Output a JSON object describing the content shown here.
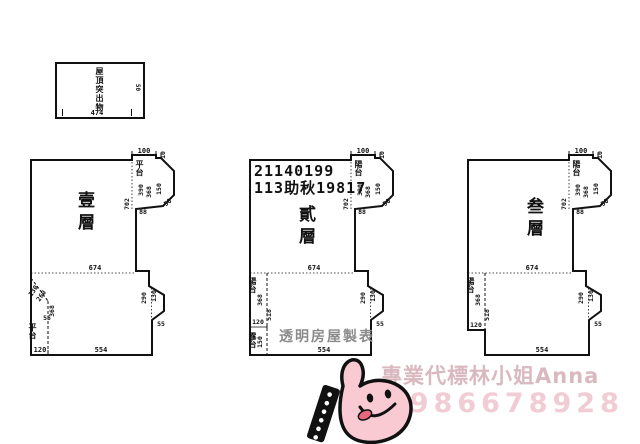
{
  "roof_box": {
    "label": "屋頂突出物",
    "width_dim": "474",
    "height_dim": "50"
  },
  "case": {
    "line1": "21140199",
    "line2": "113助秋19817"
  },
  "floors": [
    {
      "name": "壹層",
      "terrace": "平台",
      "top": "100",
      "step": "10",
      "p1": "390",
      "p2": "368",
      "p3": "150",
      "side": "702",
      "base": "88",
      "cham": "50",
      "mid": "674",
      "r1": "290",
      "r2": "130",
      "r3": "55",
      "bottom": "554",
      "bl_label": "平台",
      "bl1": "130",
      "bl2": "260",
      "bl3": "55",
      "bl4": "368",
      "bl5": "120"
    },
    {
      "name": "貳層",
      "terrace": "陽台",
      "top": "100",
      "step": "10",
      "p1": "390",
      "p2": "368",
      "p3": "150",
      "side": "702",
      "base": "88",
      "cham": "50",
      "mid": "674",
      "r1": "290",
      "r2": "130",
      "r3": "55",
      "bottom": "554",
      "bl_label": "陽台",
      "bl1": "368",
      "bl2": "518",
      "bl3": "120",
      "bl_label2": "露台",
      "bl4": "150"
    },
    {
      "name": "叁層",
      "terrace": "陽台",
      "top": "100",
      "step": "10",
      "p1": "390",
      "p2": "368",
      "p3": "150",
      "side": "702",
      "base": "88",
      "cham": "50",
      "mid": "674",
      "r1": "290",
      "r2": "130",
      "r3": "55",
      "bottom": "554",
      "bl_label": "陽台",
      "bl1": "368",
      "bl2": "518",
      "bl3": "120"
    }
  ],
  "watermarks": {
    "maker": "透明房屋製表",
    "agent": "專業代標林小姐Anna",
    "phone": "0986678928"
  },
  "icons": {
    "hand": "thumbs-up-smiley-hand"
  },
  "colors": {
    "hand_pink": "#f9cad2",
    "agent_pink": "#d9b9bf",
    "phone_pink": "#f1ccd4",
    "maker_gray": "#8b8b8b"
  }
}
